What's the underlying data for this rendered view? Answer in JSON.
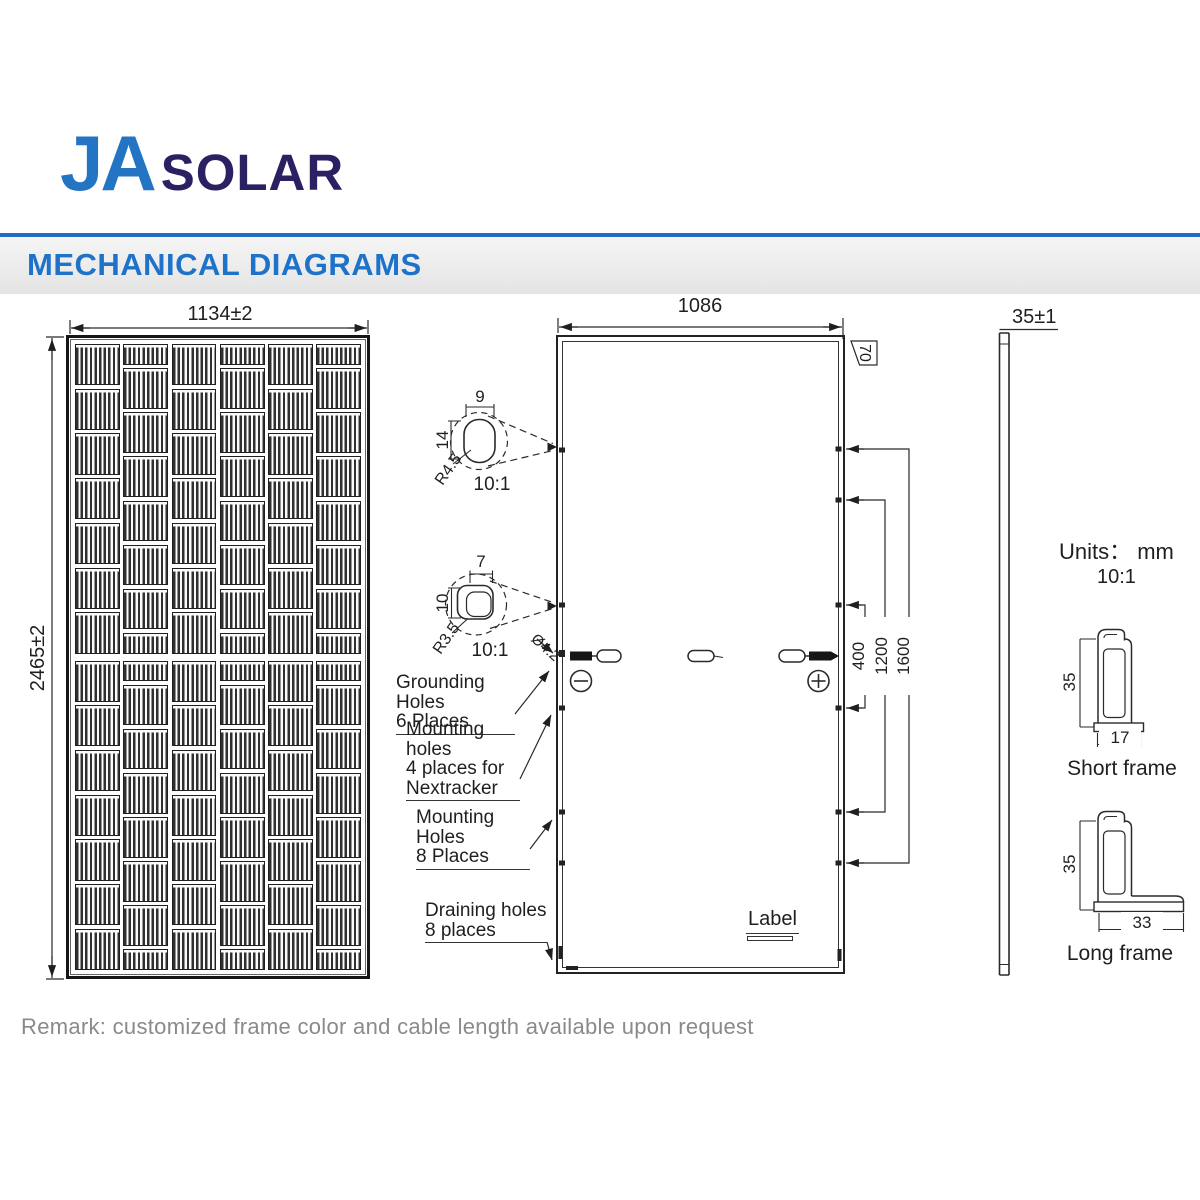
{
  "logo": {
    "ja": "JA",
    "solar": "SOLAR"
  },
  "header": {
    "title": "MECHANICAL DIAGRAMS"
  },
  "front_view": {
    "width_dim": "1134±2",
    "height_dim": "2465±2",
    "grid": {
      "cols": 6,
      "rows_per_half": 7
    }
  },
  "back_view": {
    "width_dim": "1086",
    "corner_dim": "70",
    "dims": {
      "d400": "400",
      "d1200": "1200",
      "d1600": "1600"
    },
    "hole_dia": "Ø4.2",
    "label_tag": "Label",
    "callouts": {
      "grounding": [
        "Grounding Holes",
        "6 Places"
      ],
      "nextracker": [
        "Mounting holes",
        "4 places for",
        "Nextracker"
      ],
      "mounting": [
        "Mounting Holes",
        "8 Places"
      ],
      "draining": [
        "Draining holes",
        "8 places"
      ]
    },
    "detail_top": {
      "width": "9",
      "height": "14",
      "radius": "R4.5",
      "scale": "10:1"
    },
    "detail_bottom": {
      "width": "7",
      "height": "10",
      "radius": "R3.5",
      "scale": "10:1"
    },
    "icons": {
      "minus": "minus-in-circle",
      "plus": "plus-in-circle"
    }
  },
  "side_view": {
    "width_dim": "35±1"
  },
  "notes": {
    "units": "Units： mm",
    "scale": "10:1"
  },
  "frame_sections": {
    "short": {
      "height": "35",
      "width": "17",
      "label": "Short frame"
    },
    "long": {
      "height": "35",
      "width": "33",
      "label": "Long frame"
    }
  },
  "remark": "Remark: customized frame color and cable length available upon request",
  "colors": {
    "brand_blue": "#2474c4",
    "navy": "#2a2163",
    "line": "#2a2a2a",
    "muted": "#8a8a8a"
  }
}
